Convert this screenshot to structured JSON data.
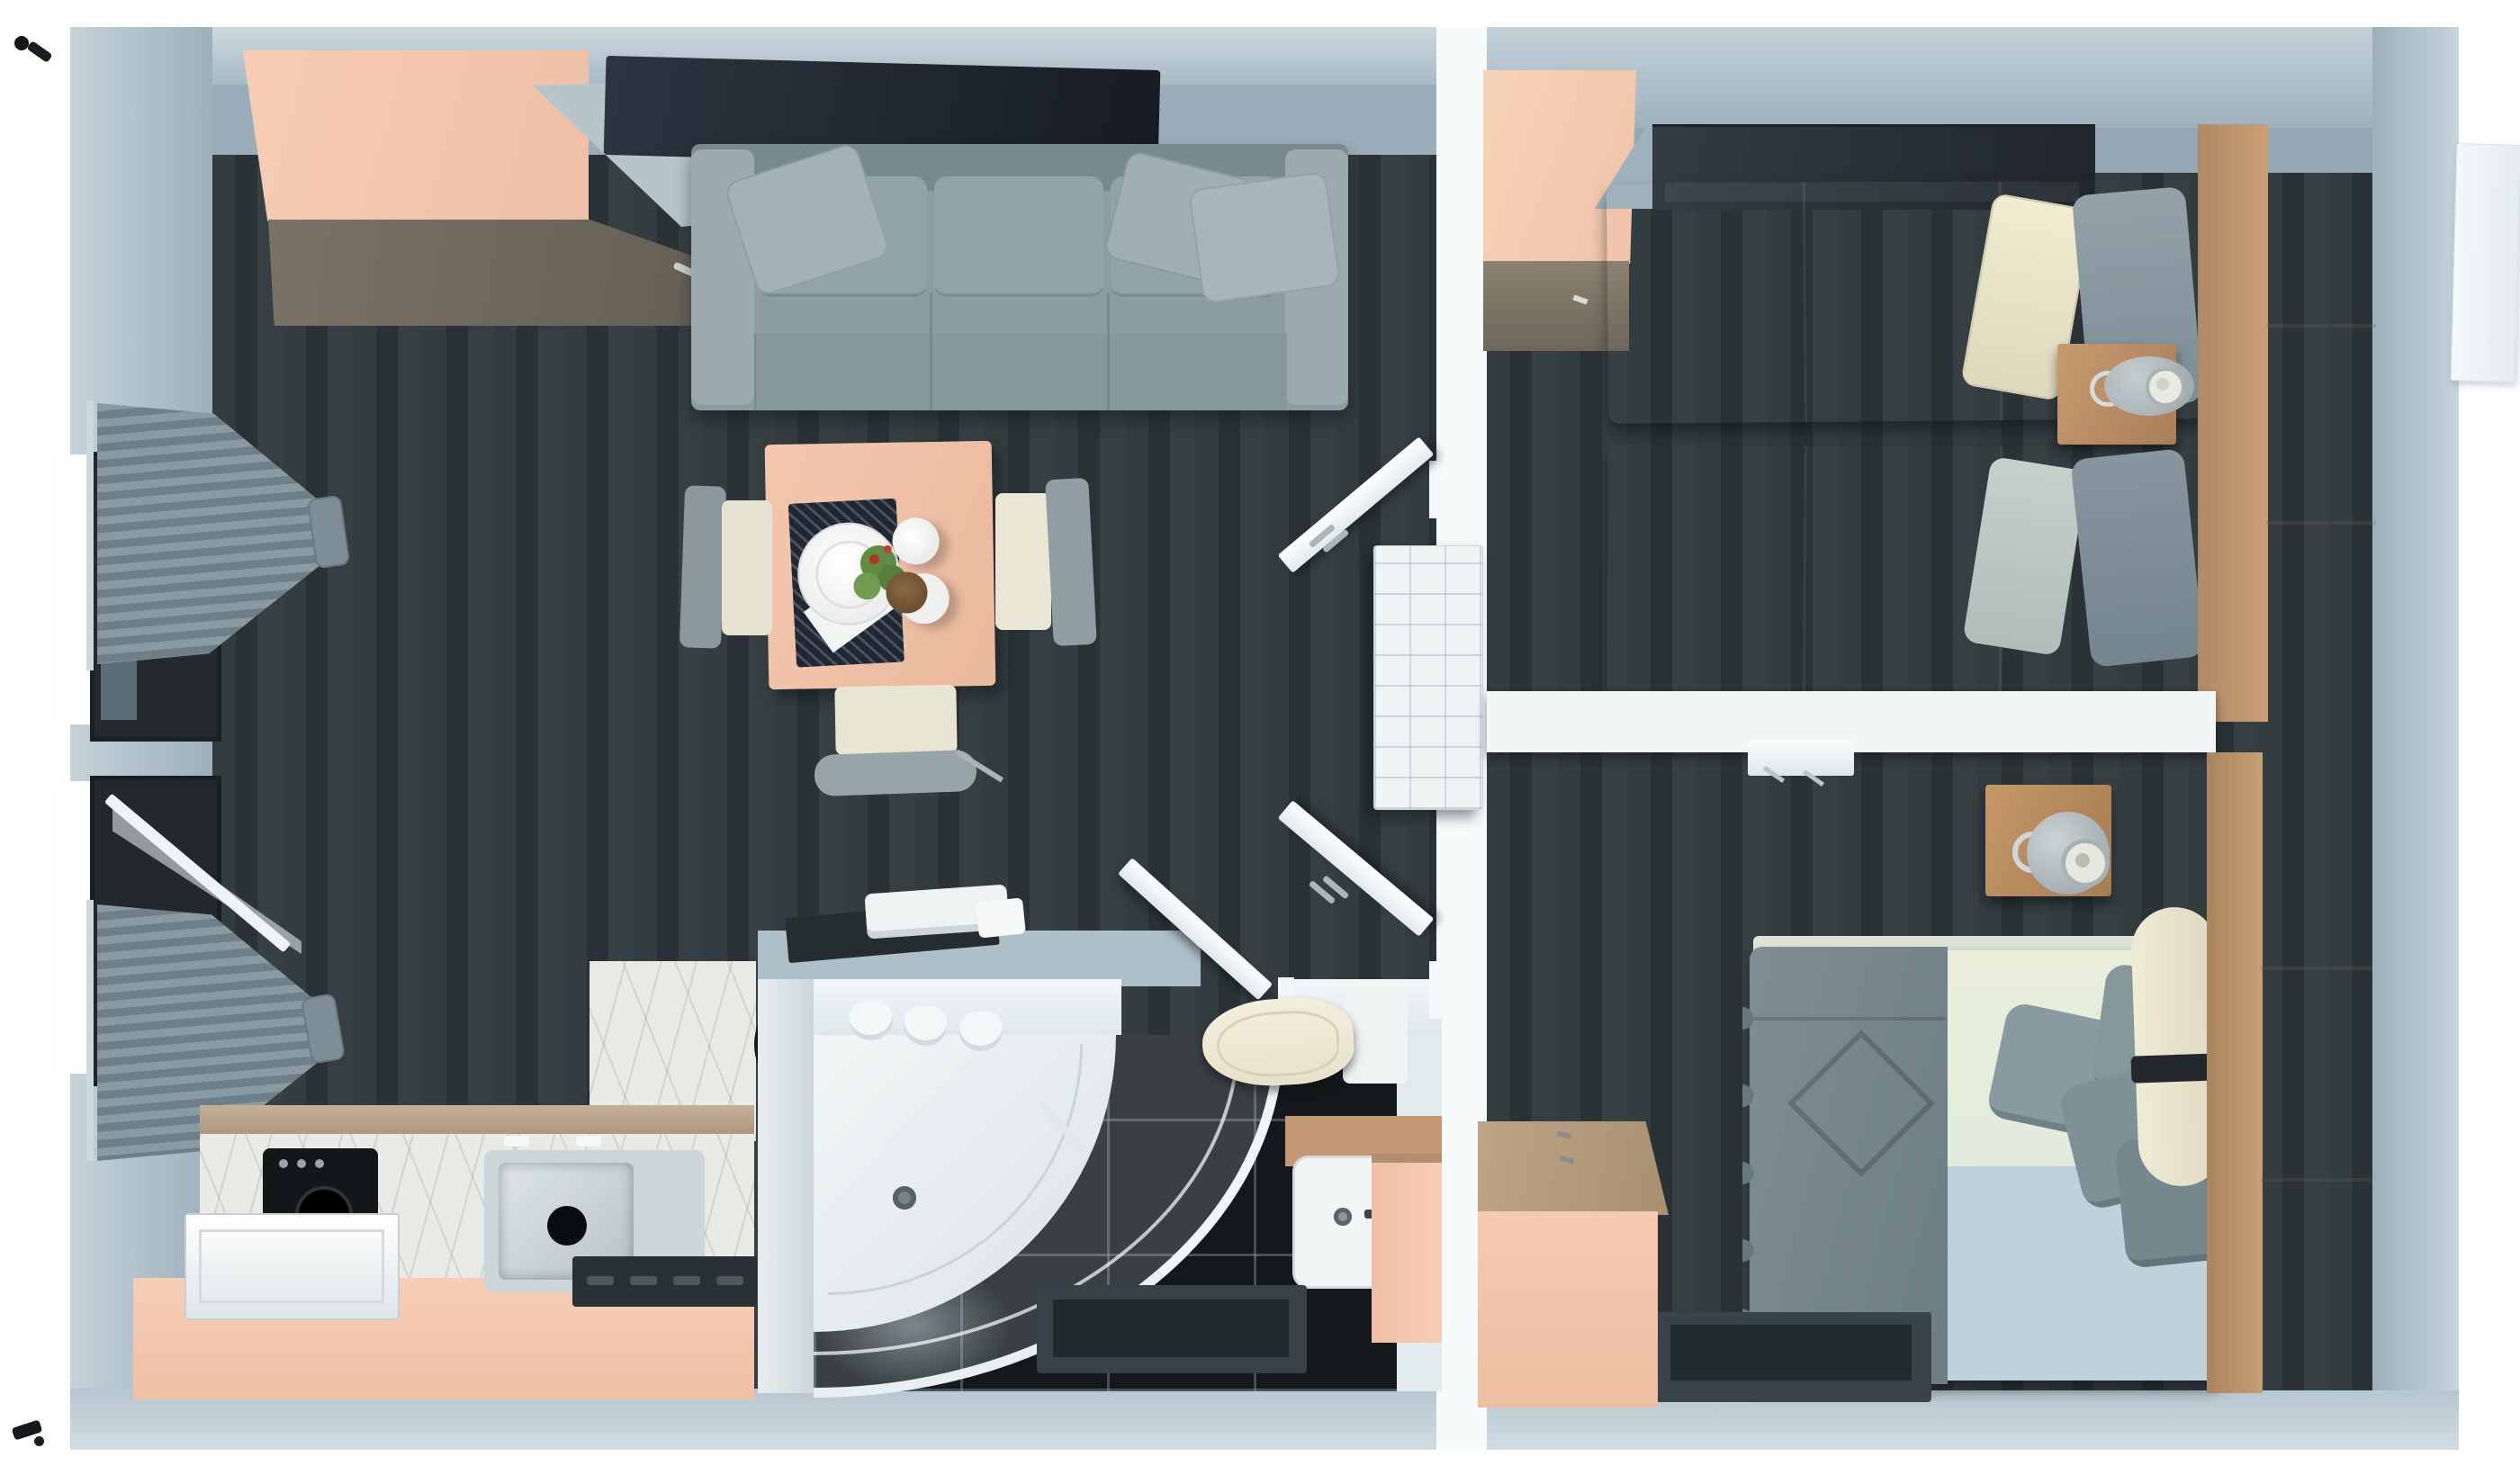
{
  "scene": {
    "title": "3D top-down floor plan render of a two-bedroom apartment",
    "style": "3d-render-top-view",
    "background": "#ffffff",
    "palette": {
      "wall": "#a9bcc6",
      "wall_face": "#95a8b3",
      "floor_dark": "#2e373a",
      "accent_peach": "#f2c5ab",
      "wood_tan": "#c09064",
      "cabinet_brown": "#6f675c",
      "sofa_gray": "#8c9da1",
      "duvet_slate": "#5c6b72",
      "pillow_cream": "#ece9cf",
      "pillow_gray": "#8a9aa1",
      "bed_cream": "#e9eedb",
      "bed_blue": "#c0d2d9",
      "tile_black": "#14181b",
      "marble": "#e9e9e5",
      "curtain_gray": "#7b8d96",
      "apple_red": "#c33a27",
      "apple_orange": "#d07030",
      "white_fixture": "#f2f6f7"
    }
  },
  "rooms": {
    "living_room": {
      "label": "Living room",
      "objects": [
        "corner-wardrobe",
        "tv-panel",
        "ac-unit",
        "sofa",
        "cushions",
        "dining-table",
        "place-setting",
        "cups",
        "plant",
        "chairs",
        "curtained-windows"
      ]
    },
    "kitchen": {
      "label": "Kitchen",
      "objects": [
        "counter",
        "marble-splash",
        "sink",
        "faucet",
        "hob",
        "washing-machine",
        "dishwasher",
        "fruit-bowl",
        "apples"
      ]
    },
    "bathroom": {
      "label": "Bathroom",
      "objects": [
        "corner-shower",
        "shower-tray",
        "toilet",
        "washbasin",
        "vanity-cabinet",
        "bath-mat",
        "hanging-towels",
        "towel-stack",
        "tray",
        "door"
      ]
    },
    "hallway": {
      "label": "Entry hall",
      "objects": [
        "door-leaf-upper",
        "door-leaf-lower",
        "radiator"
      ]
    },
    "bedroom_twin": {
      "label": "Twin bedroom",
      "objects": [
        "corner-wardrobe",
        "wall-shelf",
        "single-bed-1",
        "single-bed-2",
        "pillows",
        "nightstand",
        "table-lamp",
        "tall-wardrobe"
      ]
    },
    "bedroom_double": {
      "label": "Double bedroom",
      "objects": [
        "wall-shelf",
        "nightstand",
        "sphere-lamp",
        "double-bed",
        "quilted-throw",
        "pillow-bolster",
        "rug",
        "dresser",
        "tall-wardrobe"
      ]
    }
  }
}
